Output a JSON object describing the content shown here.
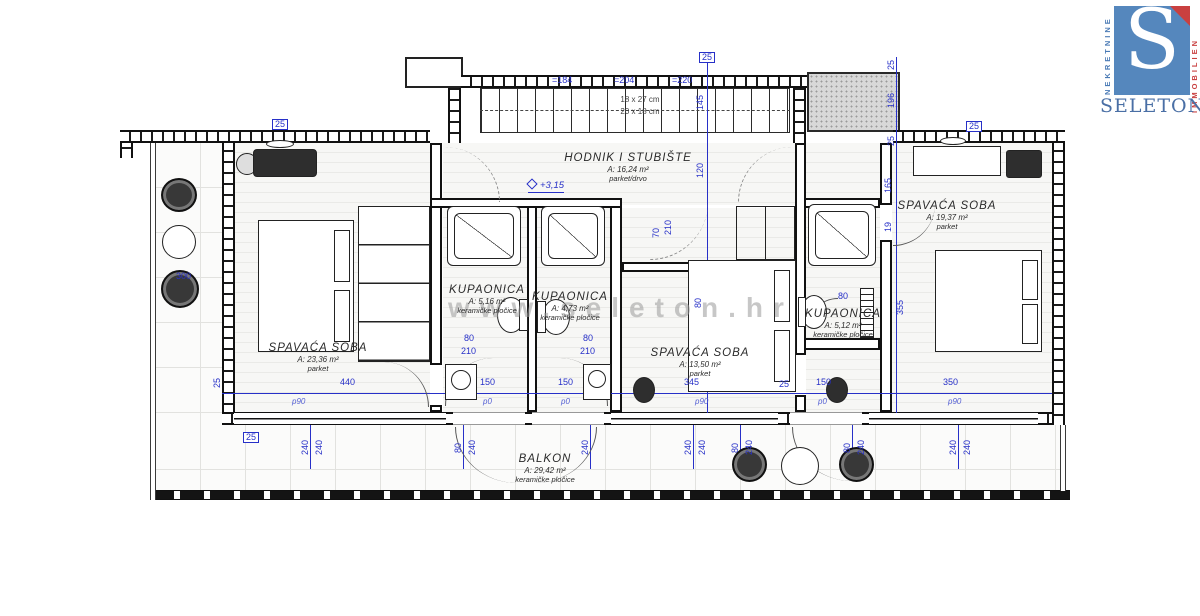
{
  "watermark": "www.seleton.hr",
  "logo": {
    "letter": "S",
    "name": "SELETON",
    "left_text": "NEKRETNINE",
    "right_text": "IMMOBILIEN",
    "blue": "#5587bd",
    "red": "#c94040",
    "text_blue": "#4a6fa5"
  },
  "plan": {
    "accent_blue": "#2730c8",
    "stair_note_1": "18 x 27 cm",
    "stair_note_2": "20 x 18 cm",
    "level_mark": "+3,15",
    "rooms": [
      {
        "name": "HODNIK I STUBIŠTE",
        "area": "A: 16,24 m²",
        "floor": "parket/drvo",
        "x": 628,
        "y": 152
      },
      {
        "name": "SPAVAĆA SOBA",
        "area": "A: 23,36 m²",
        "floor": "parket",
        "x": 318,
        "y": 342
      },
      {
        "name": "KUPAONICA",
        "area": "A: 5,16 m²",
        "floor": "keramičke pločice",
        "x": 487,
        "y": 284
      },
      {
        "name": "KUPAONICA",
        "area": "A: 4,73 m²",
        "floor": "keramičke pločice",
        "x": 570,
        "y": 291
      },
      {
        "name": "SPAVAĆA SOBA",
        "area": "A: 13,50 m²",
        "floor": "parket",
        "x": 700,
        "y": 347
      },
      {
        "name": "KUPAONICA",
        "area": "A: 5,12 m²",
        "floor": "keramičke pločice",
        "x": 843,
        "y": 308
      },
      {
        "name": "SPAVAĆA SOBA",
        "area": "A: 19,37 m²",
        "floor": "parket",
        "x": 947,
        "y": 200
      },
      {
        "name": "BALKON",
        "area": "A: 29,42 m²",
        "floor": "keramičke pločice",
        "x": 545,
        "y": 453
      }
    ],
    "dims": [
      {
        "t": "440",
        "x": 340,
        "y": 378
      },
      {
        "t": "150",
        "x": 480,
        "y": 378
      },
      {
        "t": "150",
        "x": 558,
        "y": 378
      },
      {
        "t": "345",
        "x": 684,
        "y": 378
      },
      {
        "t": "25",
        "x": 779,
        "y": 380
      },
      {
        "t": "150",
        "x": 816,
        "y": 378
      },
      {
        "t": "350",
        "x": 943,
        "y": 378
      },
      {
        "t": "25",
        "x": 213,
        "y": 378,
        "r": 1
      },
      {
        "t": "p90",
        "x": 292,
        "y": 398,
        "i": 1
      },
      {
        "t": "p0",
        "x": 483,
        "y": 398,
        "i": 1
      },
      {
        "t": "p0",
        "x": 561,
        "y": 398,
        "i": 1
      },
      {
        "t": "p90",
        "x": 695,
        "y": 398,
        "i": 1
      },
      {
        "t": "p0",
        "x": 818,
        "y": 398,
        "i": 1
      },
      {
        "t": "p90",
        "x": 948,
        "y": 398,
        "i": 1
      },
      {
        "t": "240",
        "x": 301,
        "y": 440,
        "r": 1
      },
      {
        "t": "240",
        "x": 315,
        "y": 440,
        "r": 1
      },
      {
        "t": "80",
        "x": 454,
        "y": 443,
        "r": 1
      },
      {
        "t": "240",
        "x": 468,
        "y": 440,
        "r": 1
      },
      {
        "t": "240",
        "x": 581,
        "y": 440,
        "r": 1
      },
      {
        "t": "240",
        "x": 684,
        "y": 440,
        "r": 1
      },
      {
        "t": "240",
        "x": 698,
        "y": 440,
        "r": 1
      },
      {
        "t": "80",
        "x": 731,
        "y": 443,
        "r": 1
      },
      {
        "t": "240",
        "x": 745,
        "y": 440,
        "r": 1
      },
      {
        "t": "80",
        "x": 843,
        "y": 443,
        "r": 1
      },
      {
        "t": "240",
        "x": 857,
        "y": 440,
        "r": 1
      },
      {
        "t": "240",
        "x": 949,
        "y": 440,
        "r": 1
      },
      {
        "t": "240",
        "x": 963,
        "y": 440,
        "r": 1
      },
      {
        "t": "25",
        "x": 887,
        "y": 60,
        "r": 1
      },
      {
        "t": "196",
        "x": 887,
        "y": 93,
        "r": 1
      },
      {
        "t": "25",
        "x": 887,
        "y": 136,
        "r": 1
      },
      {
        "t": "165",
        "x": 884,
        "y": 178,
        "r": 1
      },
      {
        "t": "19",
        "x": 884,
        "y": 222,
        "r": 1
      },
      {
        "t": "355",
        "x": 896,
        "y": 300,
        "r": 1
      },
      {
        "t": "145",
        "x": 696,
        "y": 95,
        "r": 1
      },
      {
        "t": "120",
        "x": 696,
        "y": 163,
        "r": 1
      },
      {
        "t": "80",
        "x": 694,
        "y": 298,
        "r": 1
      },
      {
        "t": "70",
        "x": 652,
        "y": 228,
        "r": 1
      },
      {
        "t": "210",
        "x": 664,
        "y": 220,
        "r": 1
      },
      {
        "t": "=184",
        "x": 552,
        "y": 76
      },
      {
        "t": "=204",
        "x": 614,
        "y": 76
      },
      {
        "t": "=220",
        "x": 672,
        "y": 76
      },
      {
        "t": "80",
        "x": 464,
        "y": 334
      },
      {
        "t": "210",
        "x": 461,
        "y": 347
      },
      {
        "t": "80",
        "x": 583,
        "y": 334
      },
      {
        "t": "210",
        "x": 580,
        "y": 347
      },
      {
        "t": "80",
        "x": 838,
        "y": 292
      },
      {
        "t": "300",
        "x": 176,
        "y": 272
      },
      {
        "t": "25",
        "x": 272,
        "y": 119,
        "b": 1
      },
      {
        "t": "25",
        "x": 699,
        "y": 52,
        "b": 1
      },
      {
        "t": "25",
        "x": 966,
        "y": 121,
        "b": 1
      },
      {
        "t": "25",
        "x": 243,
        "y": 432,
        "b": 1
      }
    ]
  }
}
